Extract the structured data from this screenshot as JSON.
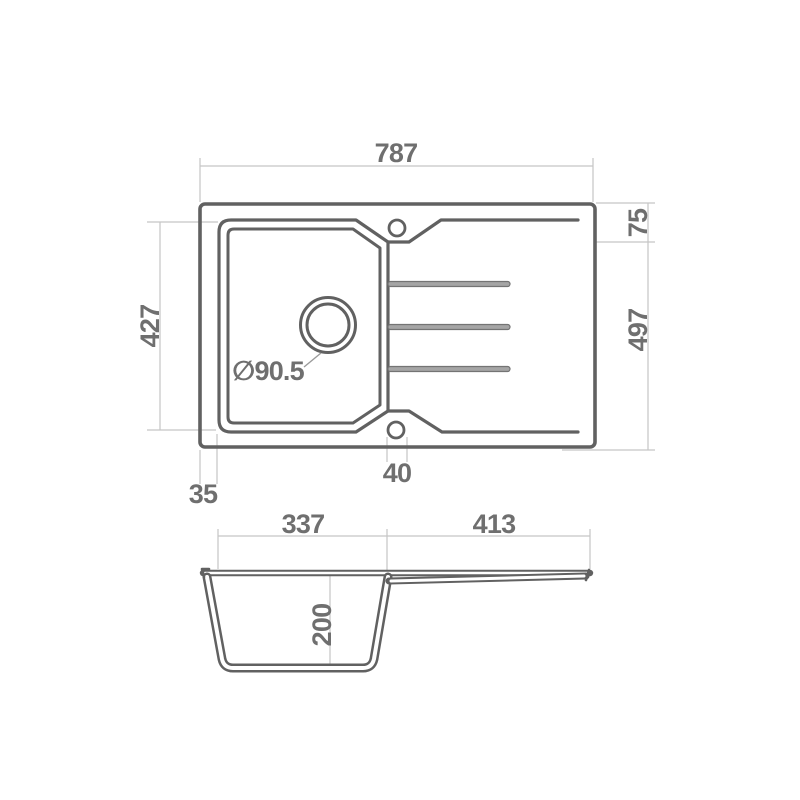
{
  "plan_view": {
    "dim_overall_width": "787",
    "dim_edge_to_recess": "75",
    "dim_overall_depth": "497",
    "dim_bowl_length": "427",
    "dim_edge_to_bowl": "35",
    "dim_recess_width": "40",
    "drain_diameter_label": "∅90.5"
  },
  "section_view": {
    "dim_bowl_width": "337",
    "dim_drainboard_width": "413",
    "dim_bowl_depth": "200"
  },
  "colors": {
    "outline": "#616161",
    "dimension_lines": "#c5c5c5",
    "label_text": "#6f6f6f",
    "background": "#ffffff"
  }
}
